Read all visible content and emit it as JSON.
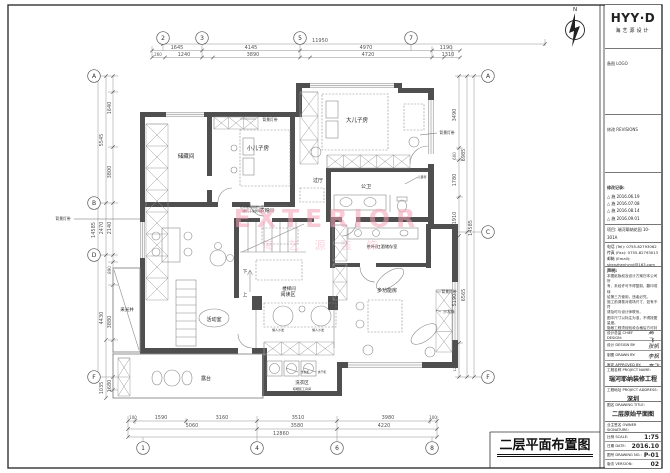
{
  "sheet": {
    "caption": "二层平面布置图"
  },
  "watermark": {
    "line1": "EXTERIOR",
    "line2": "海艺源装饰"
  },
  "plan": {
    "north": "N",
    "rooms": [
      {
        "t": "储藏间",
        "x": 186,
        "y": 158,
        "s": 5.5
      },
      {
        "t": "小儿子房",
        "x": 258,
        "y": 150,
        "s": 5.5
      },
      {
        "t": "大儿子房",
        "x": 357,
        "y": 122,
        "s": 5.5
      },
      {
        "t": "公卫",
        "x": 366,
        "y": 188,
        "s": 5
      },
      {
        "t": "过厅",
        "x": 318,
        "y": 182,
        "s": 5
      },
      {
        "t": "衣帽间",
        "x": 267,
        "y": 212,
        "s": 4.5
      },
      {
        "t": "楼梯间",
        "x": 289,
        "y": 290,
        "s": 4.5
      },
      {
        "t": "下",
        "x": 245,
        "y": 273,
        "s": 4.5
      },
      {
        "t": "上",
        "x": 245,
        "y": 296,
        "s": 4.5
      },
      {
        "t": "茶叶/红酒储存室",
        "x": 382,
        "y": 248,
        "s": 4.2
      },
      {
        "t": "采光井",
        "x": 127,
        "y": 311,
        "s": 4.5
      },
      {
        "t": "活动室",
        "x": 214,
        "y": 321,
        "s": 5
      },
      {
        "t": "阅读区",
        "x": 288,
        "y": 296,
        "s": 5
      },
      {
        "t": "多功能房",
        "x": 387,
        "y": 292,
        "s": 5
      },
      {
        "t": "洗衣区",
        "x": 302,
        "y": 384,
        "s": 4.5
      },
      {
        "t": "晾晒区工具间",
        "x": 302,
        "y": 390,
        "s": 3
      },
      {
        "t": "露台",
        "x": 206,
        "y": 380,
        "s": 5
      }
    ],
    "annos": [
      {
        "t": "背景灯带",
        "x": 270,
        "y": 121,
        "s": 3.8
      },
      {
        "t": "背景灯带",
        "x": 447,
        "y": 134,
        "s": 3.8
      },
      {
        "t": "背景灯带",
        "x": 63,
        "y": 220,
        "s": 3.8
      },
      {
        "t": "背景灯带",
        "x": 449,
        "y": 293,
        "s": 3.8
      },
      {
        "t": "沙发床",
        "x": 449,
        "y": 313,
        "s": 3.8
      },
      {
        "t": "艺术玻璃隔断位置",
        "x": 252,
        "y": 208,
        "s": 3
      },
      {
        "t": "(做儿子涂鸦墙)",
        "x": 252,
        "y": 212,
        "s": 3
      },
      {
        "t": "儿童秤",
        "x": 422,
        "y": 178,
        "s": 3
      },
      {
        "t": "懒人沙发",
        "x": 278,
        "y": 331,
        "s": 3
      },
      {
        "t": "懒人沙发",
        "x": 318,
        "y": 331,
        "s": 3
      },
      {
        "t": "洗衣机",
        "x": 305,
        "y": 373,
        "s": 2.8
      },
      {
        "t": "烘干机",
        "x": 322,
        "y": 373,
        "s": 2.8
      }
    ],
    "dims": [
      {
        "t": "11950",
        "x": 320,
        "y": 42
      },
      {
        "t": "1645",
        "x": 177,
        "y": 49
      },
      {
        "t": "4145",
        "x": 251,
        "y": 49
      },
      {
        "t": "4970",
        "x": 366,
        "y": 49
      },
      {
        "t": "1190",
        "x": 446,
        "y": 49
      },
      {
        "t": "260",
        "x": 158,
        "y": 56,
        "s": 4
      },
      {
        "t": "1240",
        "x": 184,
        "y": 56
      },
      {
        "t": "3890",
        "x": 253,
        "y": 56
      },
      {
        "t": "4720",
        "x": 368,
        "y": 56
      },
      {
        "t": "1310",
        "x": 448,
        "y": 56
      },
      {
        "t": "100",
        "x": 133,
        "y": 419,
        "s": 4
      },
      {
        "t": "1590",
        "x": 161,
        "y": 419
      },
      {
        "t": "3160",
        "x": 222,
        "y": 419
      },
      {
        "t": "3510",
        "x": 298,
        "y": 419
      },
      {
        "t": "3980",
        "x": 388,
        "y": 419
      },
      {
        "t": "100",
        "x": 433,
        "y": 419,
        "s": 4
      },
      {
        "t": "5060",
        "x": 192,
        "y": 427
      },
      {
        "t": "3580",
        "x": 297,
        "y": 427
      },
      {
        "t": "4220",
        "x": 384,
        "y": 427
      },
      {
        "t": "12860",
        "x": 281,
        "y": 435
      },
      {
        "t": "1640",
        "x": 111,
        "y": 108,
        "r": -90
      },
      {
        "t": "3800",
        "x": 111,
        "y": 172,
        "r": -90
      },
      {
        "t": "2140",
        "x": 111,
        "y": 228,
        "r": -90
      },
      {
        "t": "890",
        "x": 111,
        "y": 270,
        "r": -90,
        "s": 4
      },
      {
        "t": "3880",
        "x": 111,
        "y": 322,
        "r": -90
      },
      {
        "t": "1680",
        "x": 111,
        "y": 386,
        "r": -90
      },
      {
        "t": "5545",
        "x": 103,
        "y": 140,
        "r": -90
      },
      {
        "t": "2470",
        "x": 103,
        "y": 228,
        "r": -90
      },
      {
        "t": "4430",
        "x": 103,
        "y": 318,
        "r": -90
      },
      {
        "t": "1035",
        "x": 103,
        "y": 388,
        "r": -90
      },
      {
        "t": "14585",
        "x": 95,
        "y": 230,
        "r": -90
      },
      {
        "t": "3490",
        "x": 456,
        "y": 115,
        "r": -90
      },
      {
        "t": "600",
        "x": 456,
        "y": 156,
        "r": -90,
        "s": 4
      },
      {
        "t": "1780",
        "x": 456,
        "y": 180,
        "r": -90
      },
      {
        "t": "1910",
        "x": 456,
        "y": 218,
        "r": -90
      },
      {
        "t": "5190",
        "x": 456,
        "y": 300,
        "r": -90
      },
      {
        "t": "120",
        "x": 456,
        "y": 368,
        "r": -90,
        "s": 3.6
      },
      {
        "t": "6985",
        "x": 465,
        "y": 155,
        "r": -90
      },
      {
        "t": "6565",
        "x": 465,
        "y": 295,
        "r": -90
      },
      {
        "t": "14585",
        "x": 472,
        "y": 228,
        "r": -90
      }
    ],
    "bubbles": [
      {
        "t": "2",
        "x": 163,
        "y": 38
      },
      {
        "t": "3",
        "x": 202,
        "y": 38
      },
      {
        "t": "5",
        "x": 300,
        "y": 38
      },
      {
        "t": "7",
        "x": 411,
        "y": 38
      },
      {
        "t": "1",
        "x": 143,
        "y": 448
      },
      {
        "t": "4",
        "x": 257,
        "y": 448
      },
      {
        "t": "6",
        "x": 337,
        "y": 448
      },
      {
        "t": "8",
        "x": 432,
        "y": 448
      },
      {
        "t": "A",
        "x": 94,
        "y": 76
      },
      {
        "t": "B",
        "x": 94,
        "y": 203
      },
      {
        "t": "D",
        "x": 94,
        "y": 255
      },
      {
        "t": "F",
        "x": 94,
        "y": 377
      },
      {
        "t": "A",
        "x": 488,
        "y": 76
      },
      {
        "t": "C",
        "x": 488,
        "y": 232
      },
      {
        "t": "F",
        "x": 488,
        "y": 377
      }
    ]
  },
  "titleblock": {
    "logo": "HYY·D",
    "logo_sub": "海艺源设计",
    "sec_logo": "备图 LOGO",
    "sec_rev": "修改 REVISIONS",
    "rev_header": "修改记录:",
    "revisions": [
      "△ 施 2016.06.19",
      "△ 施 2016.07.08",
      "△ 施 2016.08.14",
      "△ 施 2016.09.01"
    ],
    "project_lines": [
      "项目: 瑞河耶纳花园 10-301A",
      "地址: 深圳市南山区"
    ],
    "contact_lines": [
      "电话 (Tel): 0755-82793062",
      "传真 (Fax): 0755-82793013",
      "邮箱 (Email): shenzhenhyyd@163.com",
      "网址 (Web): www.hyyd9.com"
    ],
    "statement_title": "声明:",
    "statement_lines": [
      "本图纸版权及设计方案归本公司所",
      "有，未经许可不得复制、翻印或转",
      "给第三方使用，违者必究。",
      "施工前请核对现场尺寸，如有不符",
      "请及时与设计师联系。",
      "图中尺寸以标注为准，不得按图量度。",
      "隐蔽工程须经验收合格后方可封闭。",
      "材料及颜色以现场封样为准。",
      "未尽事宜按国家现行规范执行。"
    ],
    "sign_rows": [
      {
        "label": "设计总监 CHIEF DESIGN:",
        "value": "高飞"
      },
      {
        "label": "设计 DESIGN BY:",
        "value": "张帆"
      },
      {
        "label": "制图 DRAWN BY:",
        "value": "李枫"
      },
      {
        "label": "审定 APPROVED BY:",
        "value": "高飞"
      }
    ],
    "fields": [
      {
        "label": "工程名称 PROJECT NAME:",
        "value": "瑞河耶纳装修工程"
      },
      {
        "label": "工程地址 PROJECT ADDRESS:",
        "value": "深圳"
      },
      {
        "label": "图名 DRAWING TITLE:",
        "value": "二层原始平面图"
      },
      {
        "label": "业主签名 OWNER SIGNATURE:",
        "value": ""
      }
    ],
    "meta": [
      {
        "label": "比例 SCALE:",
        "value": "1:75"
      },
      {
        "label": "日期 DATE:",
        "value": "2016.10"
      },
      {
        "label": "图号 DRAWING NO.:",
        "value": "P-01"
      },
      {
        "label": "版次 VERSION:",
        "value": "02"
      }
    ]
  }
}
